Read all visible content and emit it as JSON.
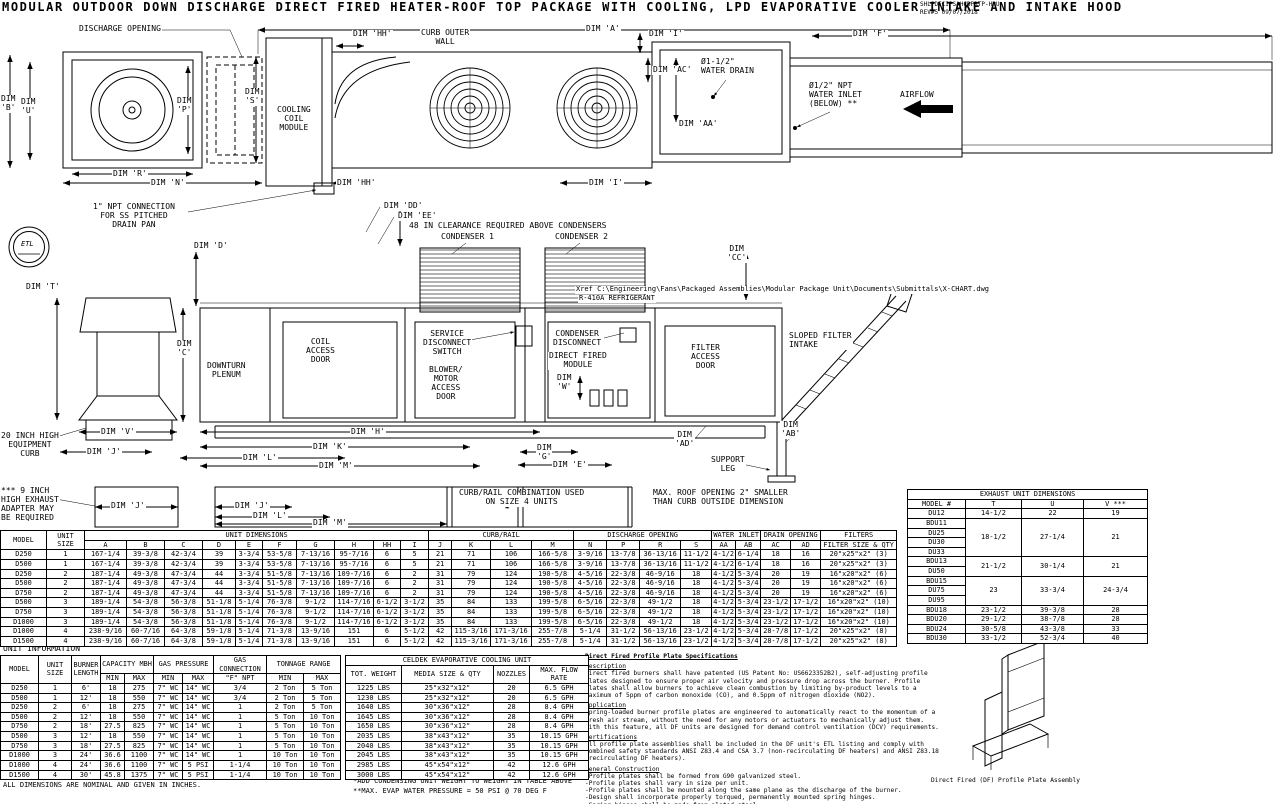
{
  "title": "MODULAR OUTDOOR DOWN DISCHARGE DIRECT FIRED HEATER-ROOF TOP PACKAGE WITH COOLING, LPD EVAPORATIVE COOLER INTAKE AND INTAKE HOOD",
  "rev_block": {
    "code": "SHLPDECIPSAHCDPRTP-HPU",
    "rev": "REV#5  09/07/2018"
  },
  "etl_mark": "ETL",
  "plan": {
    "discharge_opening": "DISCHARGE OPENING",
    "dim_a": "DIM 'A'",
    "dim_hh_top": "DIM 'HH'",
    "curb_outer_wall": "CURB OUTER\nWALL",
    "dim_i_top": "DIM 'I'",
    "dim_f": "DIM 'F'",
    "dim_ac": "DIM 'AC'",
    "water_drain": "Ø1-1/2\"\nWATER DRAIN",
    "water_inlet": "Ø1/2\" NPT\nWATER INLET\n(BELOW) **",
    "airflow": "AIRFLOW",
    "dim_aa": "DIM 'AA'",
    "dim_b": "DIM\n'B'",
    "dim_u": "DIM\n'U'",
    "dim_p": "DIM\n'P'",
    "dim_s": "DIM\n'S'",
    "cooling_coil_module": "COOLING\nCOIL\nMODULE",
    "dim_r": "DIM 'R'",
    "dim_n": "DIM 'N'",
    "dim_hh_bot": "DIM 'HH'",
    "dim_i_bot": "DIM 'I'"
  },
  "elevation": {
    "npt_note": "1\" NPT CONNECTION\nFOR SS PITCHED\nDRAIN PAN",
    "dim_dd": "DIM 'DD'",
    "dim_ee": "DIM 'EE'",
    "clearance_note": "48 IN CLEARANCE REQUIRED ABOVE CONDENSERS",
    "condenser_1": "CONDENSER 1",
    "condenser_2": "CONDENSER 2",
    "dim_cc": "DIM\n'CC'",
    "xref_note": "Xref C:\\Engineering\\Fans\\Packaged Assemblies\\Modular Package Unit\\Documents\\Submittals\\X-CHART.dwg",
    "refrigerant_note": "R-410A REFRIGERANT",
    "dim_t": "DIM 'T'",
    "dim_d": "DIM 'D'",
    "dim_c": "DIM\n'C'",
    "downturn_plenum": "DOWNTURN\nPLENUM",
    "coil_access_door": "COIL\nACCESS\nDOOR",
    "service_disconnect": "SERVICE\nDISCONNECT\nSWITCH",
    "blower_motor_door": "BLOWER/\nMOTOR\nACCESS\nDOOR",
    "condenser_disconnect": "CONDENSER\nDISCONNECT",
    "direct_fired_module": "DIRECT FIRED\nMODULE",
    "dim_w": "DIM\n'W'",
    "filter_access_door": "FILTER\nACCESS\nDOOR",
    "sloped_filter_intake": "SLOPED FILTER\nINTAKE",
    "dim_v": "DIM 'V'",
    "dim_j": "DIM 'J'",
    "dim_h": "DIM 'H'",
    "dim_k": "DIM 'K'",
    "dim_l": "DIM 'L'",
    "dim_m": "DIM 'M'",
    "dim_g": "DIM\n'G'",
    "dim_e": "DIM 'E'",
    "dim_ad": "DIM\n'AD'",
    "dim_ab": "DIM\n'AB'",
    "support_leg": "SUPPORT\nLEG",
    "equipment_curb_note": "20 INCH HIGH\nEQUIPMENT\nCURB",
    "exhaust_adapter_note": "*** 9 INCH\nHIGH EXHAUST\nADAPTER MAY\nBE REQUIRED",
    "dim_j_curb1": "DIM 'J'",
    "dim_j_curb2": "DIM 'J'",
    "dim_l_curb": "DIM 'L'",
    "dim_m_curb": "DIM 'M'",
    "curb_rail_note": "CURB/RAIL COMBINATION USED\nON SIZE 4 UNITS",
    "roof_opening_note": "MAX. ROOF OPENING 2\" SMALLER\nTHAN CURB OUTSIDE DIMENSION"
  },
  "exhaust_table": {
    "title": "EXHAUST UNIT DIMENSIONS",
    "columns": [
      "MODEL #",
      "T",
      "U",
      "V ***"
    ],
    "rows": [
      [
        "DU12",
        "14-1/2",
        "22",
        "19"
      ],
      [
        "BDU11",
        {
          "v": "18-1/2",
          "rs": 4
        },
        {
          "v": "27-1/4",
          "rs": 4
        },
        {
          "v": "21",
          "rs": 4
        }
      ],
      [
        "DU25"
      ],
      [
        "DU30"
      ],
      [
        "DU33"
      ],
      [
        "BDU13",
        {
          "v": "21-1/2",
          "rs": 2
        },
        {
          "v": "30-1/4",
          "rs": 2
        },
        {
          "v": "21",
          "rs": 2
        }
      ],
      [
        "DU50"
      ],
      [
        "BDU15",
        {
          "v": "23",
          "rs": 3
        },
        {
          "v": "33-3/4",
          "rs": 3
        },
        {
          "v": "24-3/4",
          "rs": 3
        }
      ],
      [
        "DU75"
      ],
      [
        "DU95"
      ],
      [
        "BDU18",
        "23-1/2",
        "39-3/8",
        "28"
      ],
      [
        "BDU20",
        "29-1/2",
        "38-7/8",
        "28"
      ],
      [
        "BDU24",
        "30-5/8",
        "43-3/8",
        "33"
      ],
      [
        "BDU30",
        "33-1/2",
        "52-3/4",
        "40"
      ]
    ]
  },
  "main_table": {
    "col_model": "MODEL",
    "col_unit_size": "UNIT SIZE",
    "grp_unit_dimensions": "UNIT DIMENSIONS",
    "grp_curb_rail": "CURB/RAIL",
    "grp_discharge_opening": "DISCHARGE OPENING",
    "grp_water_inlet": "WATER INLET",
    "grp_drain_opening": "DRAIN OPENING",
    "grp_filters": "FILTERS",
    "letter_row": [
      [
        "A",
        "B",
        "C",
        "D",
        "E",
        "F",
        "G",
        "H",
        "HH",
        "I",
        "J",
        "K",
        "L",
        "M",
        "N",
        "P",
        "R",
        "S",
        "AA",
        "AB",
        "AC",
        "AD",
        "FILTER SIZE & QTY"
      ]
    ],
    "rows": [
      [
        "D250",
        "1",
        "167-1/4",
        "39-3/8",
        "42-3/4",
        "39",
        "3-3/4",
        "53-5/8",
        "7-13/16",
        "95-7/16",
        "6",
        "5",
        "21",
        "71",
        "106",
        "166-5/8",
        "3-9/16",
        "13-7/8",
        "36-13/16",
        "11-1/2",
        "4-1/2",
        "6-1/4",
        "18",
        "16",
        "20\"x25\"x2\" (3)"
      ],
      [
        "D500",
        "1",
        "167-1/4",
        "39-3/8",
        "42-3/4",
        "39",
        "3-3/4",
        "53-5/8",
        "7-13/16",
        "95-7/16",
        "6",
        "5",
        "21",
        "71",
        "106",
        "166-5/8",
        "3-9/16",
        "13-7/8",
        "36-13/16",
        "11-1/2",
        "4-1/2",
        "6-1/4",
        "18",
        "16",
        "20\"x25\"x2\" (3)"
      ],
      [
        "D250",
        "2",
        "187-1/4",
        "49-3/8",
        "47-3/4",
        "44",
        "3-3/4",
        "51-5/8",
        "7-13/16",
        "109-7/16",
        "6",
        "2",
        "31",
        "79",
        "124",
        "190-5/8",
        "4-5/16",
        "22-3/8",
        "46-9/16",
        "18",
        "4-1/2",
        "5-3/4",
        "20",
        "19",
        "16\"x20\"x2\" (6)"
      ],
      [
        "D500",
        "2",
        "187-1/4",
        "49-3/8",
        "47-3/4",
        "44",
        "3-3/4",
        "51-5/8",
        "7-13/16",
        "109-7/16",
        "6",
        "2",
        "31",
        "79",
        "124",
        "190-5/8",
        "4-5/16",
        "22-3/8",
        "46-9/16",
        "18",
        "4-1/2",
        "5-3/4",
        "20",
        "19",
        "16\"x20\"x2\" (6)"
      ],
      [
        "D750",
        "2",
        "187-1/4",
        "49-3/8",
        "47-3/4",
        "44",
        "3-3/4",
        "51-5/8",
        "7-13/16",
        "109-7/16",
        "6",
        "2",
        "31",
        "79",
        "124",
        "190-5/8",
        "4-5/16",
        "22-3/8",
        "46-9/16",
        "18",
        "4-1/2",
        "5-3/4",
        "20",
        "19",
        "16\"x20\"x2\" (6)"
      ],
      [
        "D500",
        "3",
        "189-1/4",
        "54-3/8",
        "56-3/8",
        "51-1/8",
        "5-1/4",
        "76-3/8",
        "9-1/2",
        "114-7/16",
        "6-1/2",
        "3-1/2",
        "35",
        "84",
        "133",
        "199-5/8",
        "6-5/16",
        "22-3/8",
        "49-1/2",
        "18",
        "4-1/2",
        "5-3/4",
        "23-1/2",
        "17-1/2",
        "16\"x20\"x2\" (10)"
      ],
      [
        "D750",
        "3",
        "189-1/4",
        "54-3/8",
        "56-3/8",
        "51-1/8",
        "5-1/4",
        "76-3/8",
        "9-1/2",
        "114-7/16",
        "6-1/2",
        "3-1/2",
        "35",
        "84",
        "133",
        "199-5/8",
        "6-5/16",
        "22-3/8",
        "49-1/2",
        "18",
        "4-1/2",
        "5-3/4",
        "23-1/2",
        "17-1/2",
        "16\"x20\"x2\" (10)"
      ],
      [
        "D1000",
        "3",
        "189-1/4",
        "54-3/8",
        "56-3/8",
        "51-1/8",
        "5-1/4",
        "76-3/8",
        "9-1/2",
        "114-7/16",
        "6-1/2",
        "3-1/2",
        "35",
        "84",
        "133",
        "199-5/8",
        "6-5/16",
        "22-3/8",
        "49-1/2",
        "18",
        "4-1/2",
        "5-3/4",
        "23-1/2",
        "17-1/2",
        "16\"x20\"x2\" (10)"
      ],
      [
        "D1000",
        "4",
        "238-9/16",
        "60-7/16",
        "64-3/8",
        "59-1/8",
        "5-1/4",
        "71-3/8",
        "13-9/16",
        "151",
        "6",
        "5-1/2",
        "42",
        "115-3/16",
        "171-3/16",
        "255-7/8",
        "5-1/4",
        "31-1/2",
        "56-13/16",
        "23-1/2",
        "4-1/2",
        "5-3/4",
        "28-7/8",
        "17-1/2",
        "20\"x25\"x2\" (8)"
      ],
      [
        "D1500",
        "4",
        "238-9/16",
        "60-7/16",
        "64-3/8",
        "59-1/8",
        "5-1/4",
        "71-3/8",
        "13-9/16",
        "151",
        "6",
        "5-1/2",
        "42",
        "115-3/16",
        "171-3/16",
        "255-7/8",
        "5-1/4",
        "31-1/2",
        "56-13/16",
        "23-1/2",
        "4-1/2",
        "5-3/4",
        "28-7/8",
        "17-1/2",
        "20\"x25\"x2\" (8)"
      ]
    ]
  },
  "unit_info": {
    "heading": "UNIT INFORMATION",
    "col_model": "MODEL",
    "col_unit_size": "UNIT SIZE",
    "col_burner_length": "BURNER\nLENGTH",
    "grp_capacity": "CAPACITY MBH",
    "grp_gas_pressure": "GAS PRESSURE",
    "grp_gas_connection": "GAS CONNECTION",
    "grp_tonnage": "TONNAGE RANGE",
    "sub_row": [
      [
        "MIN",
        "MAX",
        "MIN",
        "MAX",
        "\"F\" NPT",
        "MIN",
        "MAX"
      ]
    ],
    "rows": [
      [
        "D250",
        "1",
        "6'",
        "18",
        "275",
        "7\" WC",
        "14\" WC",
        "3/4",
        "2 Ton",
        "5 Ton"
      ],
      [
        "D500",
        "1",
        "12'",
        "18",
        "550",
        "7\" WC",
        "14\" WC",
        "3/4",
        "2 Ton",
        "5 Ton"
      ],
      [
        "D250",
        "2",
        "6'",
        "18",
        "275",
        "7\" WC",
        "14\" WC",
        "1",
        "2 Ton",
        "5 Ton"
      ],
      [
        "D500",
        "2",
        "12'",
        "18",
        "550",
        "7\" WC",
        "14\" WC",
        "1",
        "5 Ton",
        "10 Ton"
      ],
      [
        "D750",
        "2",
        "18'",
        "27.5",
        "825",
        "7\" WC",
        "14\" WC",
        "1",
        "5 Ton",
        "10 Ton"
      ],
      [
        "D500",
        "3",
        "12'",
        "18",
        "550",
        "7\" WC",
        "14\" WC",
        "1",
        "5 Ton",
        "10 Ton"
      ],
      [
        "D750",
        "3",
        "18'",
        "27.5",
        "825",
        "7\" WC",
        "14\" WC",
        "1",
        "5 Ton",
        "10 Ton"
      ],
      [
        "D1000",
        "3",
        "24'",
        "36.6",
        "1100",
        "7\" WC",
        "14\" WC",
        "1",
        "10 Ton",
        "10 Ton"
      ],
      [
        "D1000",
        "4",
        "24'",
        "36.6",
        "1100",
        "7\" WC",
        "5 PSI",
        "1-1/4",
        "10 Ton",
        "10 Ton"
      ],
      [
        "D1500",
        "4",
        "30'",
        "45.8",
        "1375",
        "7\" WC",
        "5 PSI",
        "1-1/4",
        "10 Ton",
        "10 Ton"
      ]
    ]
  },
  "celdek": {
    "title": "CELDEK EVAPORATIVE COOLING UNIT",
    "columns": [
      "TOT. WEIGHT",
      "MEDIA SIZE & QTY",
      "NOZZLES",
      "MAX. FLOW RATE"
    ],
    "rows": [
      [
        "1225 LBS",
        "25\"x32\"x12\"",
        "20",
        "6.5 GPH"
      ],
      [
        "1230 LBS",
        "25\"x32\"x12\"",
        "20",
        "6.5 GPH"
      ],
      [
        "1640 LBS",
        "30\"x36\"x12\"",
        "28",
        "8.4 GPH"
      ],
      [
        "1645 LBS",
        "30\"x36\"x12\"",
        "28",
        "8.4 GPH"
      ],
      [
        "1650 LBS",
        "30\"x36\"x12\"",
        "28",
        "8.4 GPH"
      ],
      [
        "2035 LBS",
        "38\"x43\"x12\"",
        "35",
        "10.15 GPH"
      ],
      [
        "2040 LBS",
        "38\"x43\"x12\"",
        "35",
        "10.15 GPH"
      ],
      [
        "2045 LBS",
        "38\"x43\"x12\"",
        "35",
        "10.15 GPH"
      ],
      [
        "2985 LBS",
        "45\"x54\"x12\"",
        "42",
        "12.6 GPH"
      ],
      [
        "3000 LBS",
        "45\"x54\"x12\"",
        "42",
        "12.6 GPH"
      ]
    ]
  },
  "specs": {
    "title": "Direct Fired Profile Plate Specifications",
    "description_heading": "Description",
    "description_body": "Direct fired burners shall have patented (US Patent No: US6623352B2), self-adjusting profile plates designed to ensure proper air velocity and pressure drop across the burner. Profile plates shall allow burners to achieve clean combustion by limiting by-product levels to a maximum of 5ppm of carbon monoxide (CO), and 0.5ppm of nitrogen dioxide (NO2).",
    "application_heading": "Application",
    "application_body": "Spring-loaded burner profile plates are engineered to automatically react to the momentum of a fresh air stream, without the need for any motors or actuators to mechanically adjust them. With this feature, all DF units are designed for demand control ventilation (DCV) requirements.",
    "certifications_heading": "Certifications",
    "certifications_body": "All profile plate assemblies shall be included in the DF unit's ETL listing and comply with combined safety standards ANSI Z83.4 and CSA 3.7 (non-recirculating DF heaters) and ANSI Z83.18 (recirculating DF heaters).",
    "construction_heading": "General Construction",
    "construction_body": "-Profile plates shall be formed from G90 galvanized steel.\n-Profile plates shall vary in size per unit.\n-Profile plates shall be mounted along the same plane as the discharge of the burner.\n-Design shall incorporate properly torqued, permanently mounted spring hinges.\n-Spring hinges shall be made from plated steel.",
    "caption": "Direct Fired (DF) Profile Plate Assembly"
  },
  "footnotes": {
    "dims_note": "ALL DIMENSIONS ARE NOMINAL AND GIVEN IN INCHES.",
    "condensing_note": "*ADD CONDENSING UNIT WEIGHT TO WEIGHT IN TABLE ABOVE",
    "evap_note": "**MAX. EVAP WATER PRESSURE = 50 PSI @ 70 DEG F"
  }
}
